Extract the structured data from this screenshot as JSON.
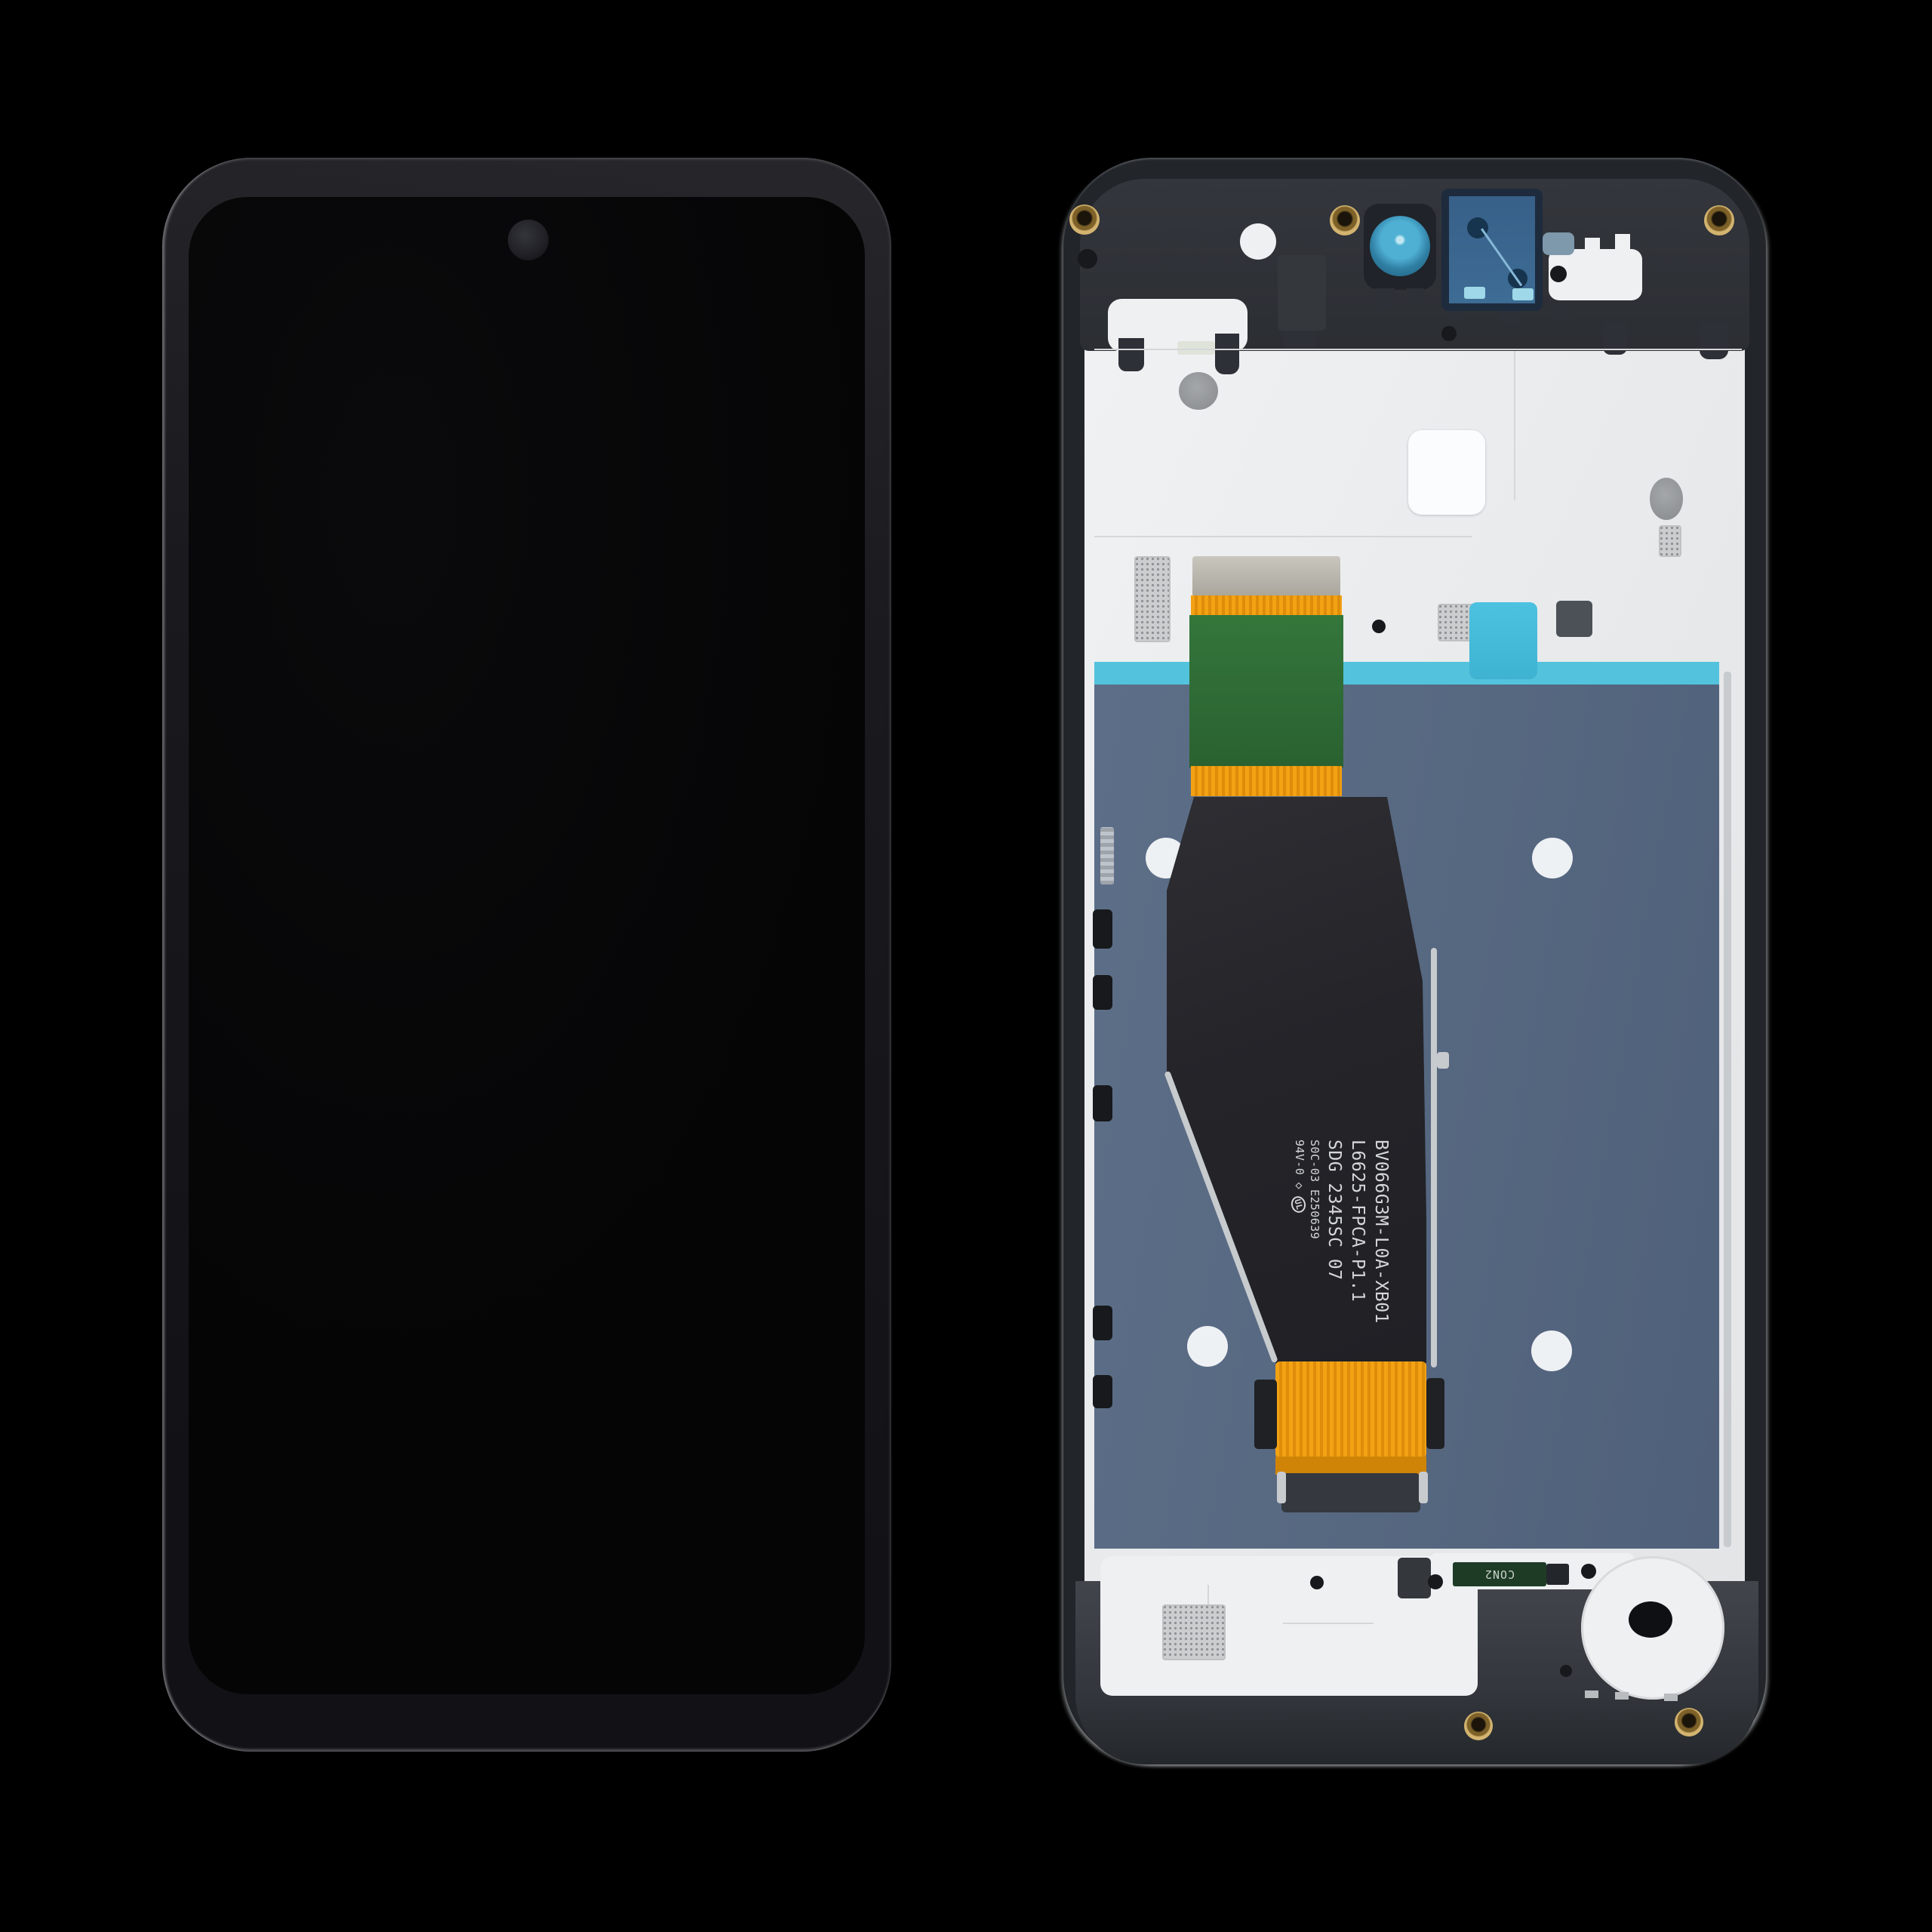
{
  "flex_cable": {
    "marking_line1": "BV066G3M-L0A-XB01",
    "marking_line2": "L6625-FPCA-P1.1",
    "marking_line3": "SDG 2345SC 07",
    "marking_line4": "S0C-03 E250639",
    "marking_line5": "94V-0",
    "diamond_mark": "◇",
    "ul_mark": "UL"
  },
  "bottom_board": {
    "connector_label": "CON2"
  },
  "colors": {
    "background": "#000000",
    "phone_body_dark": "#1a1a1e",
    "screen_black": "#060607",
    "frame_charcoal": "#2b2e33",
    "backplate_white": "#eceef0",
    "display_back_slate_blue": "#57687f",
    "adhesive_strip_cyan": "#53c3dd",
    "flex_green_pcb": "#2f6d35",
    "flex_orange_connector": "#f09c14",
    "flex_ribbon_black": "#26262a",
    "front_camera_cutout_teal": "#45a9cc",
    "sensor_window_navy": "#3a688f",
    "screw_gold": "#c4a75f",
    "sticker_white": "#fbfcfd",
    "con2_board_green": "#1e3b26"
  }
}
